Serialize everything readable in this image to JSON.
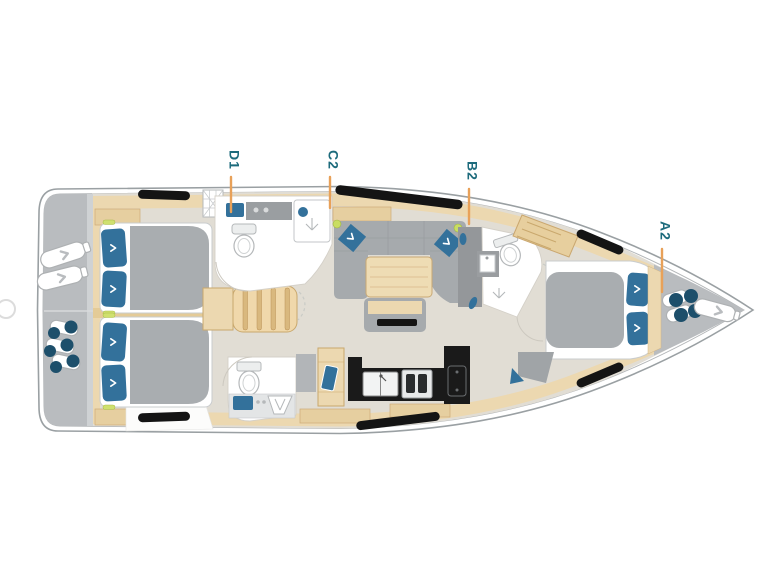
{
  "diagram": {
    "type": "yacht-deck-layout-plan",
    "orientation": "bow-right",
    "cabin_labels": [
      {
        "id": "d1",
        "text": "D1"
      },
      {
        "id": "c2",
        "text": "C2"
      },
      {
        "id": "b2",
        "text": "B2"
      },
      {
        "id": "a2",
        "text": "A2"
      }
    ],
    "colors": {
      "label_text": "#1d6b7c",
      "leader_line": "#e8a159",
      "hull_outline": "#9aa0a3",
      "deck_gray": "#b9bcbf",
      "wood": "#ecd8b0",
      "wood_dark": "#e6cfa0",
      "floor": "#e1ddd4",
      "upholstery_gray": "#a6aaad",
      "cushion_blue": "#33719b",
      "rope_navy": "#1d4f6b",
      "counter_black": "#1a1a1a",
      "handle_green": "#cfe06e"
    }
  }
}
